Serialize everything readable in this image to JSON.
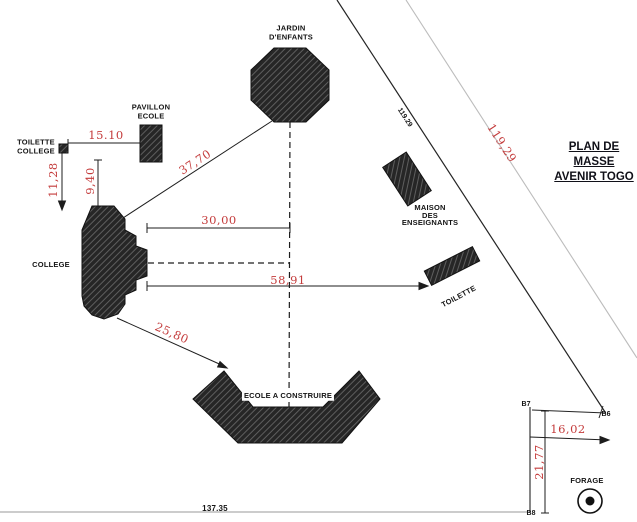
{
  "title": {
    "line1": "PLAN DE MASSE",
    "line2": "AVENIR TOGO"
  },
  "labels": {
    "jardin_1": "JARDIN",
    "jardin_2": "D'ENFANTS",
    "pavillon_1": "PAVILLON",
    "pavillon_2": "ECOLE",
    "toilette_college_1": "TOILETTE",
    "toilette_college_2": "COLLEGE",
    "college": "COLLEGE",
    "maison_1": "MAISON",
    "maison_2": "DES",
    "maison_3": "ENSEIGNANTS",
    "toilette": "TOILETTE",
    "ecole": "ECOLE A CONSTRUIRE",
    "forage": "FORAGE"
  },
  "dimensions": {
    "d15_10": "15.10",
    "d11_28": "11,28",
    "d9_40": "9,40",
    "d37_70": "37,70",
    "d30_00": "30,00",
    "d58_91": "58,91",
    "d25_80": "25,80",
    "d119_29": "119,29",
    "d16_02": "16,02",
    "d21_77": "21,77"
  },
  "annotations": {
    "boundary_black": "119.29",
    "bottom_length": "137.35",
    "b6": "B6",
    "b7": "B7",
    "b8": "B8"
  },
  "colors": {
    "dimension_red": "#c43c3c",
    "line_black": "#1d1d1d",
    "boundary_gray": "#bcbcbc",
    "hatch_fill": "#262626"
  }
}
